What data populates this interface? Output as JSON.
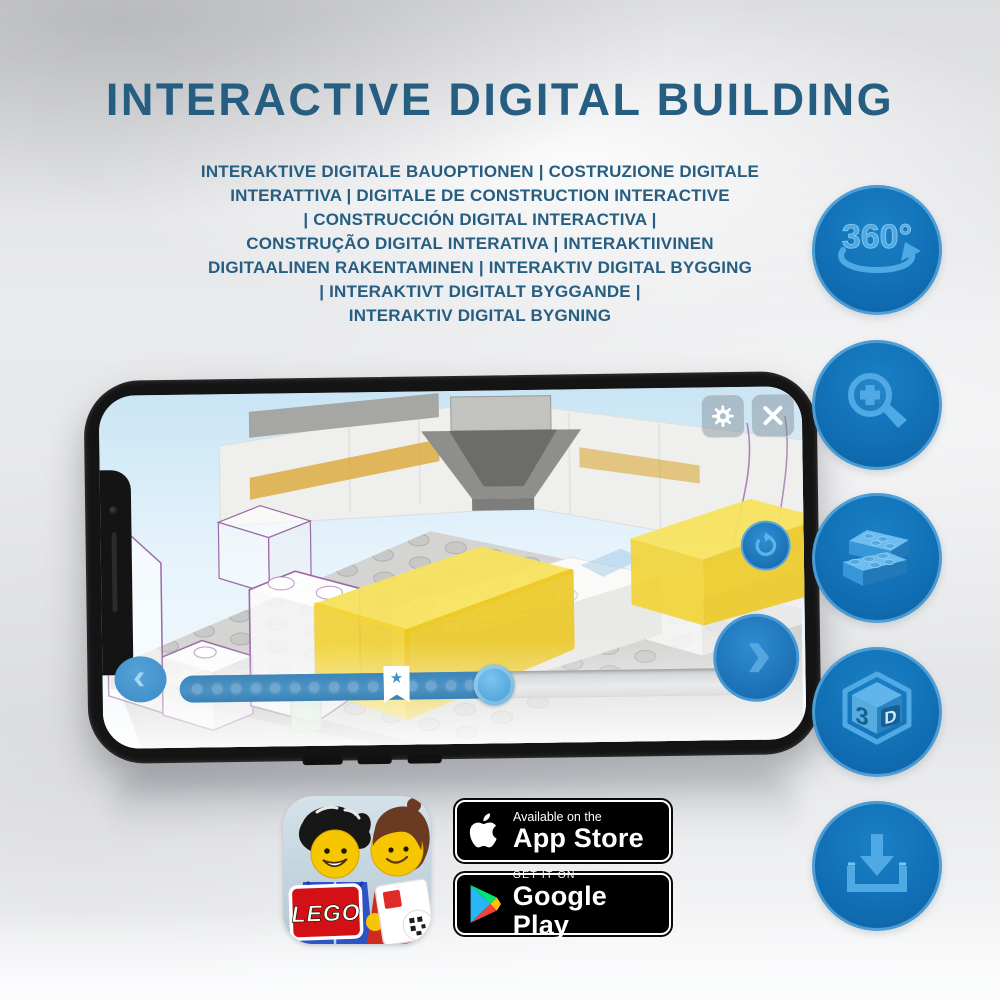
{
  "header": {
    "title": "INTERACTIVE DIGITAL BUILDING",
    "subtitle_lines": [
      "INTERAKTIVE DIGITALE BAUOPTIONEN | COSTRUZIONE DIGITALE",
      "INTERATTIVA | DIGITALE DE CONSTRUCTION INTERACTIVE",
      "| CONSTRUCCIÓN DIGITAL INTERACTIVA |",
      "CONSTRUÇÃO DIGITAL INTERATIVA | INTERAKTIIVINEN",
      "DIGITAALINEN RAKENTAMINEN | INTERAKTIV DIGITAL BYGGING",
      "| INTERAKTIVT DIGITALT BYGGANDE |",
      "INTERAKTIV DIGITAL BYGNING"
    ]
  },
  "feature_icons": {
    "rotate_360": {
      "label": "360°"
    },
    "cube_3d": {
      "label_3": "3",
      "label_d": "D"
    }
  },
  "phone_app": {
    "progress": {
      "fill_percent": 55,
      "bookmark_percent": 38,
      "bookmark_star": "★"
    }
  },
  "store": {
    "app_store": {
      "prefix": "Available on the",
      "name": "App Store"
    },
    "google_play": {
      "prefix": "GET IT ON",
      "name": "Google Play"
    },
    "app_icon_logo": "LEGO"
  },
  "colors": {
    "title_blue": "#265E82",
    "accent_blue": "#1272B8",
    "icon_art_blue": "#4FA9E4",
    "brick_yellow": "#F0CF2F",
    "outline_purple": "#9B6AA5",
    "badge_black": "#000000"
  }
}
